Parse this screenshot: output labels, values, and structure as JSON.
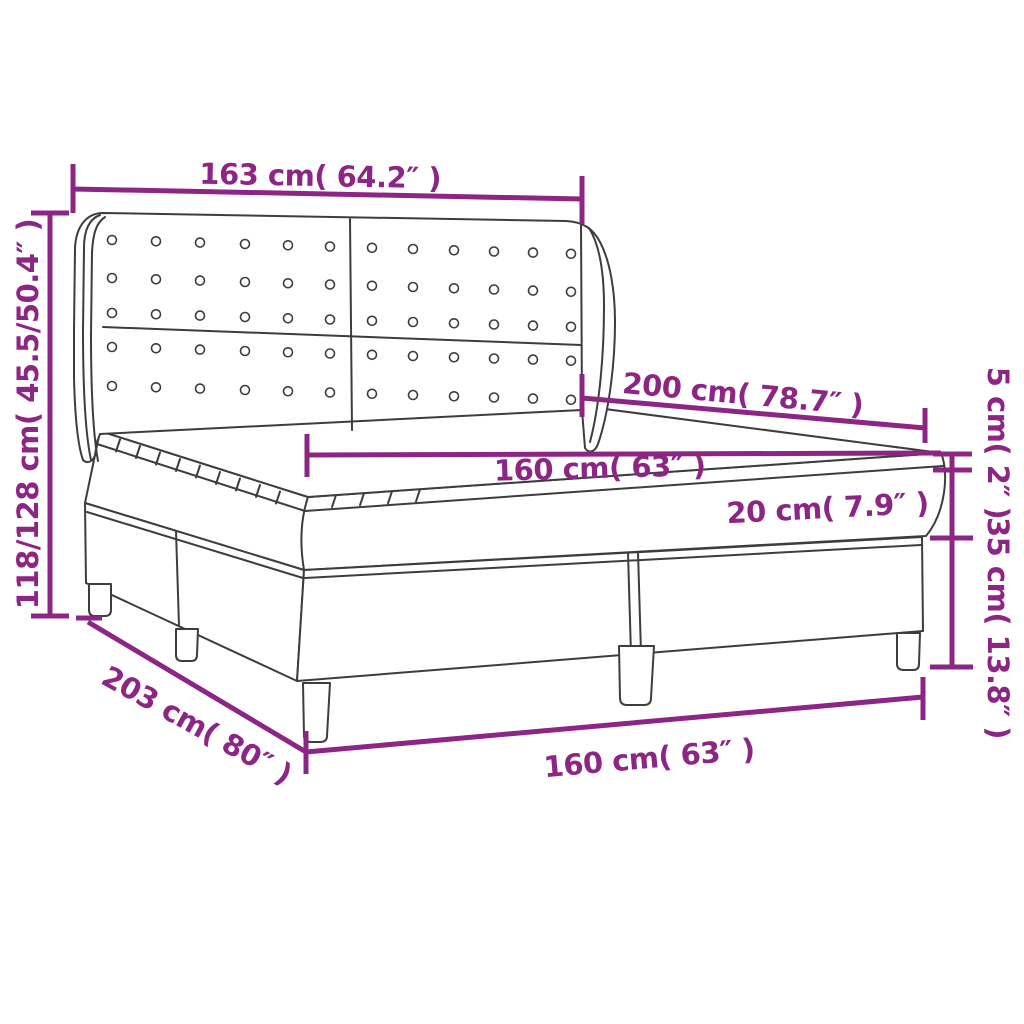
{
  "diagram": {
    "subject": "box-spring-bed-dimension-diagram",
    "colors": {
      "dimension_accent": "#8d2585",
      "line_art": "#3d3d3d",
      "background": "#ffffff"
    },
    "dimensions": {
      "headboard_width": {
        "label": "163 cm( 64.2″ )"
      },
      "total_height": {
        "label": "118/128 cm( 45.5/50.4″ )"
      },
      "bed_length": {
        "label": "200 cm( 78.7″ )"
      },
      "mattress_width": {
        "label": "160 cm( 63″ )"
      },
      "mattress_height": {
        "label": "20 cm( 7.9″ )"
      },
      "topper_height": {
        "label": "5 cm( 2″ )"
      },
      "base_height": {
        "label": "35 cm( 13.8″ )"
      },
      "total_length": {
        "label": "203 cm( 80″ )"
      },
      "base_width": {
        "label": "160 cm( 63″ )"
      }
    }
  }
}
